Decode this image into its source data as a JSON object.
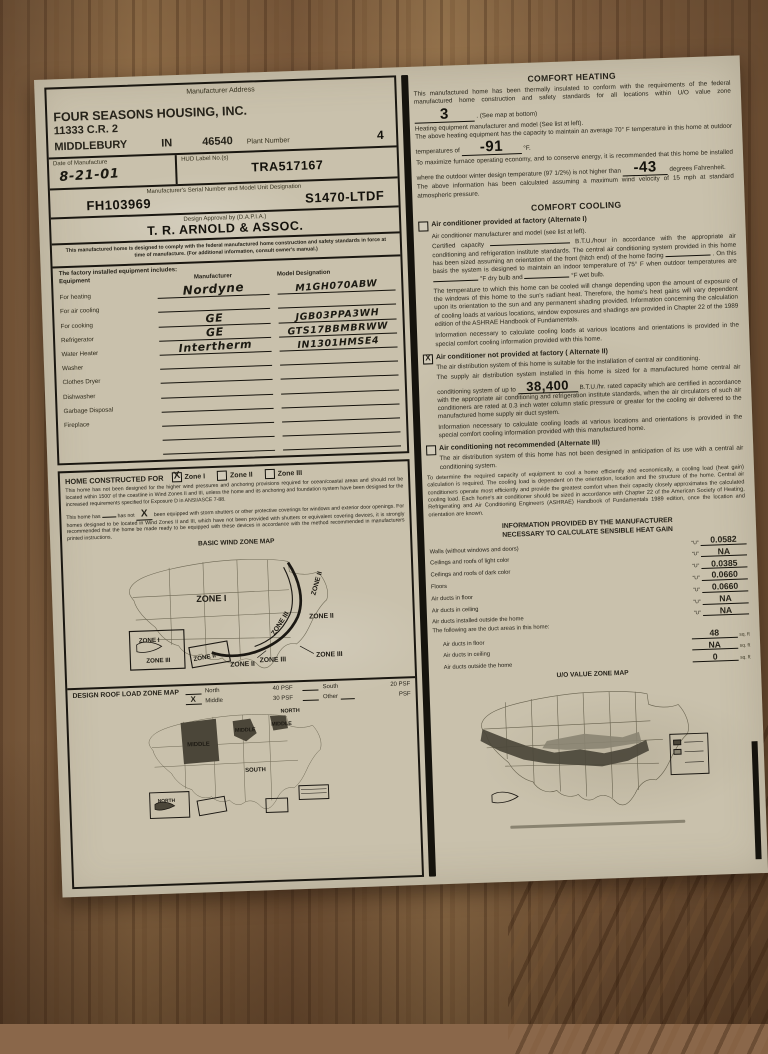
{
  "colors": {
    "paper": "#c9c1ac",
    "ink": "#1a1711",
    "wood": "#8a674a",
    "map_shade": "#4b4639"
  },
  "company": {
    "section_label": "Manufacturer Address",
    "name": "FOUR SEASONS HOUSING, INC.",
    "street": "11333 C.R. 2",
    "city": "MIDDLEBURY",
    "state": "IN",
    "zip": "46540",
    "plant_label": "Plant Number",
    "plant": "4"
  },
  "identity": {
    "date_label": "Date of Manufacture",
    "date": "8-21-01",
    "hud_label": "HUD Label No.(s)",
    "hud": "TRA517167",
    "serial_label": "Manufacturer's Serial Number and Model Unit Designation",
    "serial": "FH103969",
    "model": "S1470-LTDF",
    "dapia_label": "Design Approval by (D.A.P.I.A.)",
    "dapia": "T. R. ARNOLD & ASSOC.",
    "compliance": "This manufactured home is designed to comply with the federal manufactured home construction and safety standards in force at time of manufacture. (For additional information, consult owner's manual.)"
  },
  "equipment": {
    "intro": "The factory installed equipment includes:",
    "col_equipment": "Equipment",
    "col_manufacturer": "Manufacturer",
    "col_model": "Model Designation",
    "rows": [
      {
        "label": "For heating",
        "manufacturer": "Nordyne",
        "model": "M1GH070ABW"
      },
      {
        "label": "For air cooling",
        "manufacturer": "",
        "model": ""
      },
      {
        "label": "For cooking",
        "manufacturer": "GE",
        "model": "JGB03PPA3WH"
      },
      {
        "label": "Refrigerator",
        "manufacturer": "GE",
        "model": "GTS17BBMBRWW"
      },
      {
        "label": "Water Heater",
        "manufacturer": "Intertherm",
        "model": "IN1301HMSE4"
      },
      {
        "label": "Washer",
        "manufacturer": "",
        "model": ""
      },
      {
        "label": "Clothes Dryer",
        "manufacturer": "",
        "model": ""
      },
      {
        "label": "Dishwasher",
        "manufacturer": "",
        "model": ""
      },
      {
        "label": "Garbage Disposal",
        "manufacturer": "",
        "model": ""
      },
      {
        "label": "Fireplace",
        "manufacturer": "",
        "model": ""
      },
      {
        "label": "",
        "manufacturer": "",
        "model": ""
      },
      {
        "label": "",
        "manufacturer": "",
        "model": ""
      }
    ]
  },
  "wind": {
    "title": "HOME CONSTRUCTED FOR",
    "zones": [
      {
        "label": "Zone I",
        "mark": "X"
      },
      {
        "label": "Zone II",
        "mark": ""
      },
      {
        "label": "Zone III",
        "mark": ""
      }
    ],
    "para1": "This home has not been designed for the higher wind pressures and anchoring provisions required for ocean/coastal areas and should not be located within 1500' of the coastline in Wind Zones II and III, unless the home and its anchoring and foundation system have been designed for the increased requirements specified for Exposure D in ANSI/ASCE 7-88.",
    "para2_pre": "This home has",
    "has_mark": "",
    "para2_mid": "has not",
    "hasnot_mark": "X",
    "para2_rest": "been equipped with storm shutters or other protective coverings for windows and exterior door openings. For homes designed to be located in Wind Zones II and III, which have not been provided with shutters or equivalent covering devices, it is strongly recommended that the home be made ready to be equipped with these devices in accordance with the method recommended in manufacturers printed instructions.",
    "map_title": "BASIC WIND ZONE MAP",
    "map": {
      "center": "ZONE I",
      "east_coast": "ZONE II",
      "east_inner": "ZONE III",
      "atlantic": "ZONE II",
      "gulf_ii": "ZONE II",
      "gulf_iii": "ZONE III",
      "gulf_iii2": "ZONE III",
      "ak_i": "ZONE I",
      "ak_iii": "ZONE III",
      "hi": "ZONE II"
    }
  },
  "roof": {
    "title": "DESIGN ROOF LOAD ZONE MAP",
    "options": [
      {
        "mark": "",
        "label": "North",
        "psf": "40 PSF"
      },
      {
        "mark": "X",
        "label": "Middle",
        "psf": "30 PSF"
      },
      {
        "mark": "",
        "label": "South",
        "psf": "20 PSF"
      },
      {
        "mark": "",
        "label": "Other",
        "psf": "PSF"
      }
    ],
    "map": {
      "north": "NORTH",
      "middle_w": "MIDDLE",
      "middle_c": "MIDDLE",
      "middle_e": "MIDDLE",
      "south": "SOUTH",
      "ak": "NORTH"
    }
  },
  "heating": {
    "title": "COMFORT HEATING",
    "p1": "This manufactured home has been thermally insulated to conform with the requirements of the federal manufactured home construction and safety standards for all locations within U/O value zone",
    "zone": "3",
    "p1b": ". (See map at bottom)",
    "p2": "Heating equipment manufacturer and model (See list at left).",
    "p3": "The above heating equipment has the capacity to maintain an average 70° F temperature in this home at outdoor temperatures of",
    "temp": "-91",
    "temp_unit": "°F.",
    "p4": "To maximize furnace operating economy, and to conserve energy, it is recommended that this home be installed where the outdoor winter design temperature (97 1/2%) is not higher than",
    "temp2": "-43",
    "temp2_unit": "degrees Fahrenheit.",
    "p5": "The above information has been calculated assuming a maximum wind velocity of 15 mph at standard atmospheric pressure."
  },
  "cooling": {
    "title": "COMFORT COOLING",
    "alt1_mark": "",
    "alt1_title": "Air conditioner provided at factory (Alternate I)",
    "alt1_p1": "Air conditioner manufacturer and model (see list at left).",
    "alt1_p2a": "Certified capacity",
    "alt1_p2b": "B.T.U./hour in accordance with the appropriate air conditioning and refrigeration institute standards.",
    "alt1_p2c": "The central air conditioning system provided in this home has been sized assuming an orientation of the front (hitch end) of the home facing",
    "alt1_p2d": ". On this basis the system is designed to maintain an indoor temperature of 75° F when outdoor",
    "alt1_p2e": "temperatures are",
    "alt1_p2f": "°F dry bulb and",
    "alt1_p2g": "°F wet bulb.",
    "alt1_p3": "The temperature to which this home can be cooled will change depending upon the amount of exposure of the windows of this home to the sun's radiant heat. Therefore, the home's heat gains will vary dependent upon its orientation to the sun and any permanent shading provided. Information concerning the calculation of cooling loads at various locations, window exposures and shadings are provided in Chapter 22 of the 1989 edition of the ASHRAE Handbook of Fundamentals.",
    "alt1_p4": "Information necessary to calculate cooling loads at various locations and orientations is provided in the special comfort cooling information provided with this home.",
    "alt2_mark": "X",
    "alt2_title": "Air conditioner not provided at factory ( Alternate II)",
    "alt2_p1": "The air distribution system of this home is suitable for the installation of central air conditioning.",
    "alt2_p2a": "The supply air distribution system installed in this home is sized for a manufactured home central air conditioning system of up to",
    "alt2_btu": "38,400",
    "alt2_p2b": "B.T.U./hr. rated capacity which are certified in accordance with the appropriate air conditioning and refrigeration institute standards, when the air circulators of such air conditioners are rated at 0.3 inch water column static pressure or greater for the cooling air delivered to the manufactured home supply air duct system.",
    "alt2_p3": "Information necessary to calculate cooling loads at various locations and orientations is provided in the special comfort cooling information provided with this manufactured home.",
    "alt3_mark": "",
    "alt3_title": "Air conditioning not recommended (Alternate III)",
    "alt3_p1": "The air distribution system of this home has not been designed in anticipation of its use with a central air conditioning system.",
    "sizing_para": "To determine the required capacity of equipment to cool a home efficiently and economically, a cooling load (heat gain) calculation is required. The cooling load is dependent on the orientation, location and the structure of the home. Central air conditioners operate most efficiently and provide the greatest comfort when their capacity closely approximates the calculated cooling load. Each home's air conditioner should be sized in accordance with Chapter 22 of the American Society of Heating, Refrigerating and Air Conditioning Engineers (ASHRAE) Handbook of Fundamentals 1989 edition, once the location and orientation are known."
  },
  "heatgain": {
    "title1": "INFORMATION PROVIDED BY THE MANUFACTURER",
    "title2": "NECESSARY TO CALCULATE SENSIBLE HEAT GAIN",
    "rows": [
      {
        "label": "Walls (without windows and doors)",
        "u": "\"U\"",
        "value": "0.0582"
      },
      {
        "label": "Ceilings and roofs of light color",
        "u": "\"U\"",
        "value": "NA"
      },
      {
        "label": "Ceilings and roofs of dark color",
        "u": "\"U\"",
        "value": "0.0385"
      },
      {
        "label": "Floors",
        "u": "\"U\"",
        "value": "0.0660"
      },
      {
        "label": "Air ducts in floor",
        "u": "\"U\"",
        "value": "0.0660"
      },
      {
        "label": "Air ducts in ceiling",
        "u": "\"U\"",
        "value": "NA"
      },
      {
        "label": "Air ducts installed outside the home",
        "u": "\"U\"",
        "value": "NA"
      }
    ],
    "duct_intro": "The following are the duct areas in this home:",
    "duct_rows": [
      {
        "label": "Air ducts in floor",
        "value": "48",
        "unit": "sq. ft"
      },
      {
        "label": "Air ducts in ceiling",
        "value": "NA",
        "unit": "sq. ft"
      },
      {
        "label": "Air ducts outside the home",
        "value": "0",
        "unit": "sq. ft"
      }
    ],
    "uo_map_title": "U/O VALUE ZONE MAP"
  }
}
